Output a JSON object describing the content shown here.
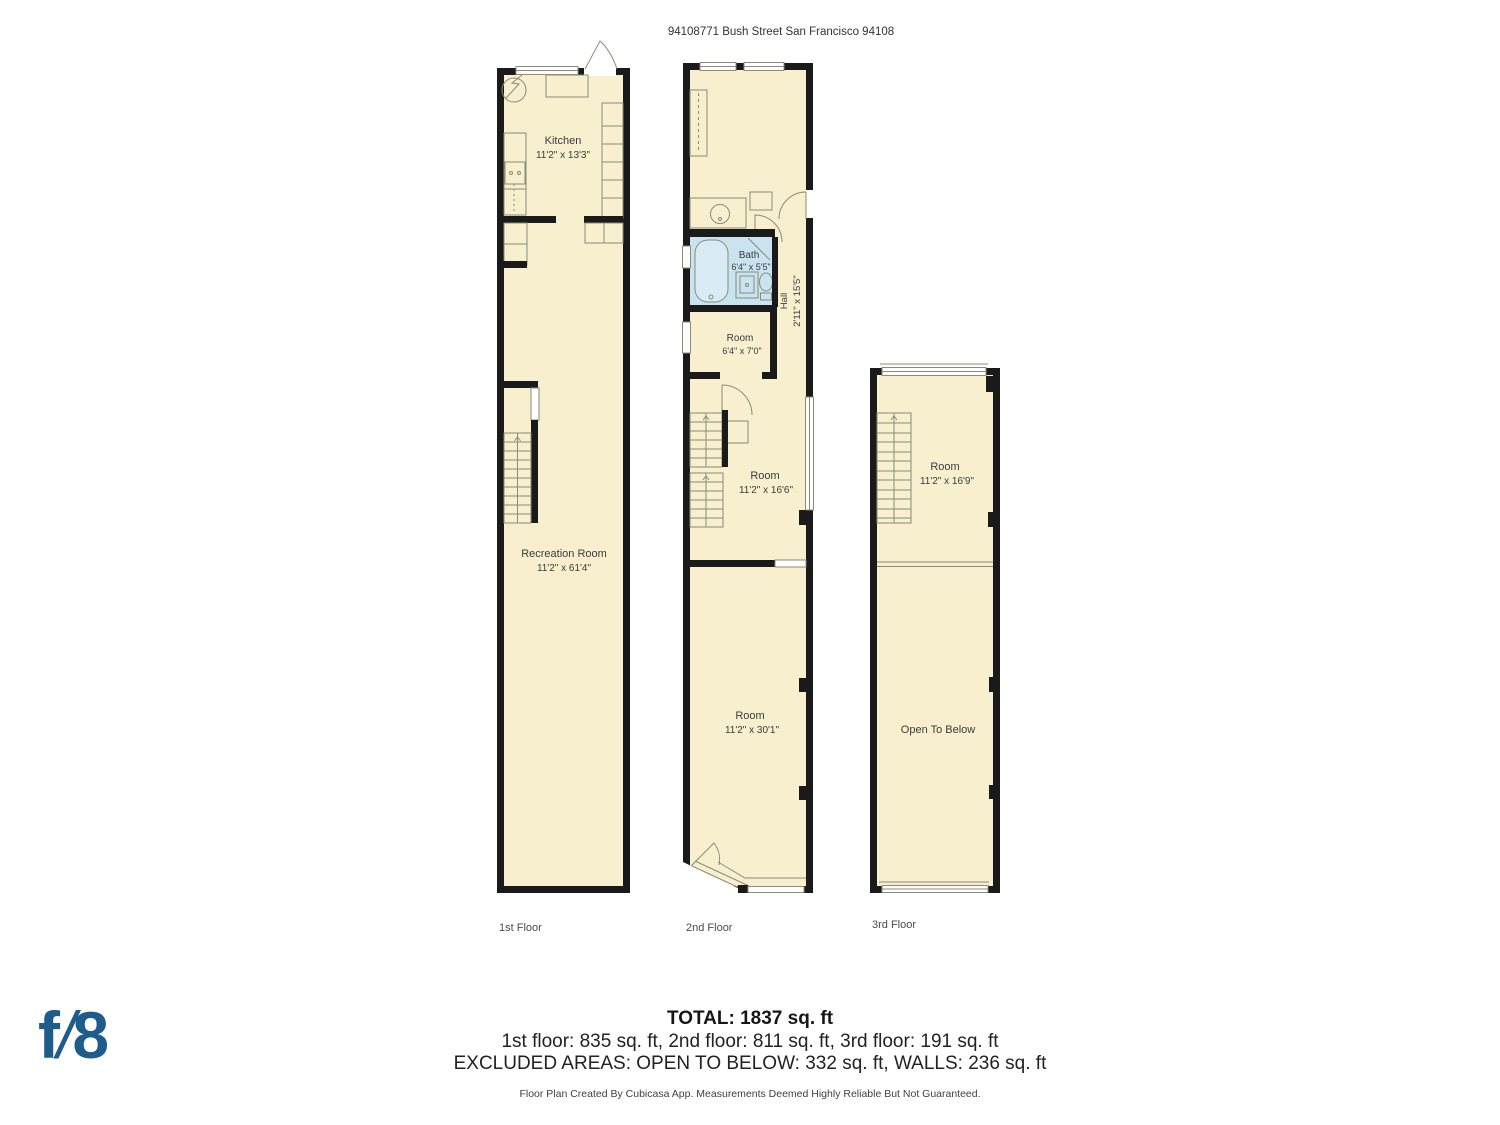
{
  "header": {
    "address": "94108771 Bush Street San Francisco 94108"
  },
  "floors": [
    {
      "label": "1st Floor",
      "rooms": [
        {
          "name": "Kitchen",
          "dims": "11'2\" x 13'3\""
        },
        {
          "name": "Recreation Room",
          "dims": "11'2\" x 61'4\""
        }
      ]
    },
    {
      "label": "2nd Floor",
      "rooms": [
        {
          "name": "Room",
          "dims": "11'1\" x 15'1\""
        },
        {
          "name": "Bath",
          "dims": "6'4\" x 5'5\""
        },
        {
          "name": "Hall",
          "dims": "2'11\" x 15'5\""
        },
        {
          "name": "Room",
          "dims": "6'4\" x 7'0\""
        },
        {
          "name": "Room",
          "dims": "11'2\" x 16'6\""
        },
        {
          "name": "Room",
          "dims": "11'2\" x 30'1\""
        }
      ]
    },
    {
      "label": "3rd Floor",
      "rooms": [
        {
          "name": "Room",
          "dims": "11'2\" x 16'9\""
        },
        {
          "name": "Open To Below",
          "dims": ""
        }
      ]
    }
  ],
  "summary": {
    "total": "TOTAL: 1837 sq. ft",
    "floors_line": "1st floor: 835 sq. ft, 2nd floor: 811 sq. ft, 3rd floor: 191 sq. ft",
    "excluded_line": "EXCLUDED AREAS: OPEN TO BELOW: 332 sq. ft, WALLS: 236 sq. ft",
    "disclaimer": "Floor Plan Created By Cubicasa App. Measurements Deemed Highly Reliable But Not Guaranteed."
  },
  "logo": {
    "f": "f",
    "slash": "/",
    "eight": "8"
  },
  "colors": {
    "floor_fill": "#f7efcd",
    "wall": "#1a1a1a",
    "bath_fill": "#c9e4f0",
    "logo_blue": "#1e5c8c"
  }
}
